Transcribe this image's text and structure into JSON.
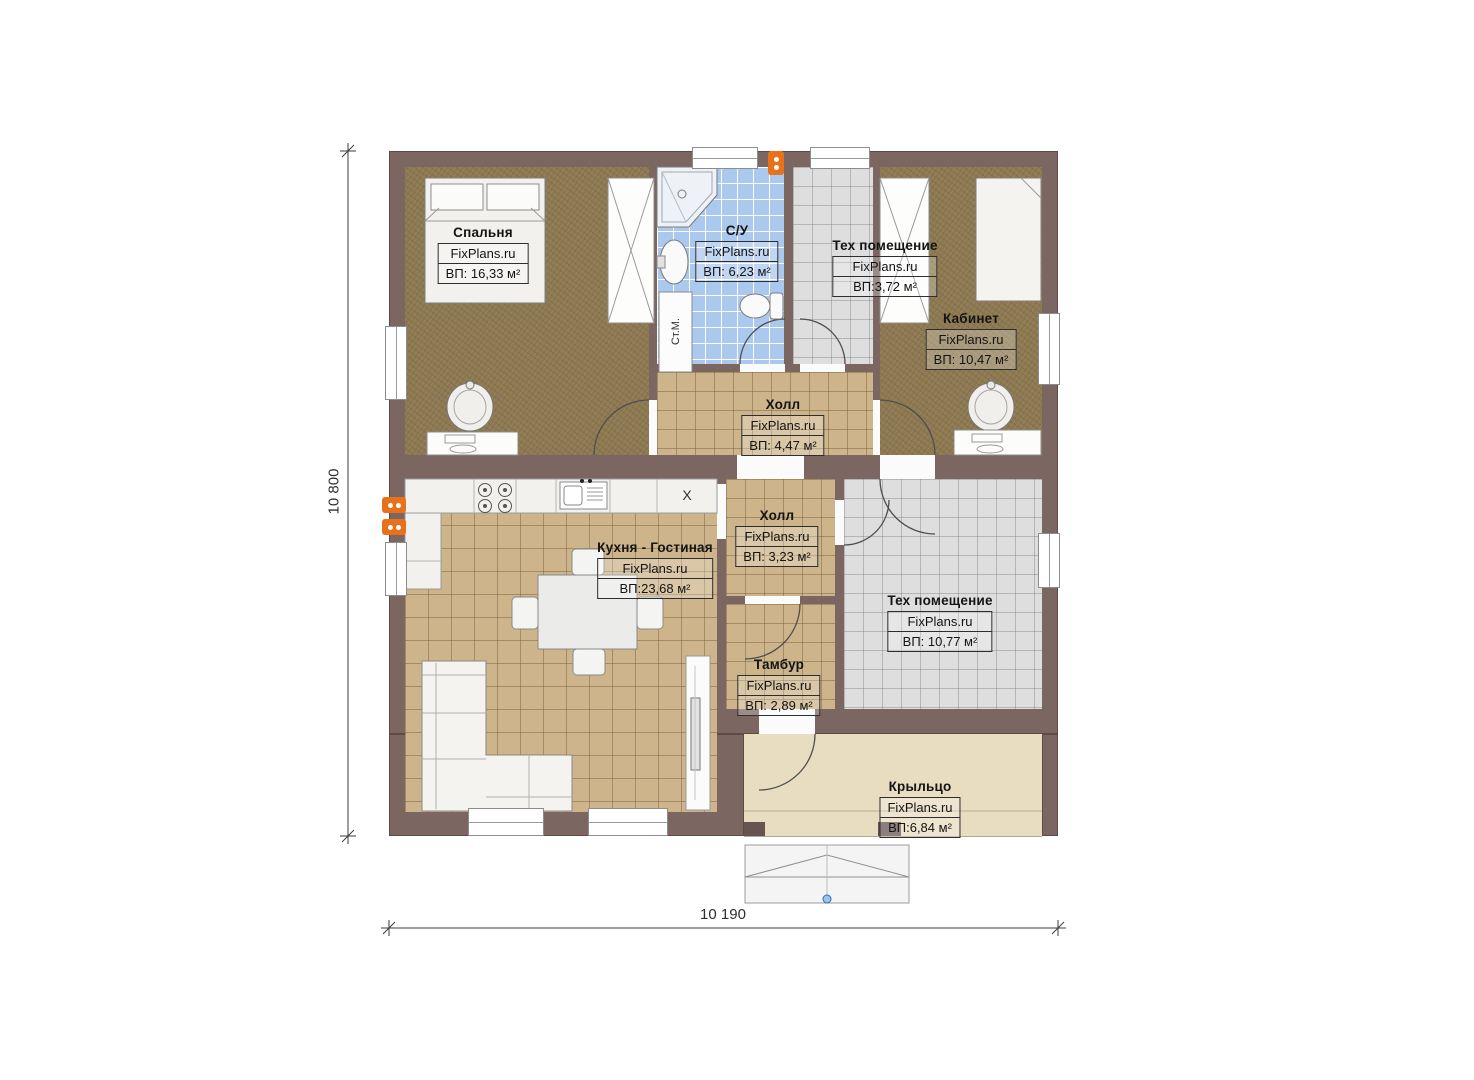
{
  "brand": "FixPlans.ru",
  "dimensions": {
    "height_label": "10 800",
    "width_label": "10 190"
  },
  "rooms": [
    {
      "id": "bedroom",
      "title": "Спальня",
      "brand": "FixPlans.ru",
      "area": "ВП: 16,33 м²"
    },
    {
      "id": "bathroom",
      "title": "С/У",
      "brand": "FixPlans.ru",
      "area": "ВП: 6,23 м²"
    },
    {
      "id": "tech-small",
      "title": "Тех помещение",
      "brand": "FixPlans.ru",
      "area": "ВП:3,72 м²"
    },
    {
      "id": "office",
      "title": "Кабинет",
      "brand": "FixPlans.ru",
      "area": "ВП: 10,47 м²"
    },
    {
      "id": "hall-upper",
      "title": "Холл",
      "brand": "FixPlans.ru",
      "area": "ВП: 4,47 м²"
    },
    {
      "id": "kitchen-living",
      "title": "Кухня - Гостиная",
      "brand": "FixPlans.ru",
      "area": "ВП:23,68 м²"
    },
    {
      "id": "hall-lower",
      "title": "Холл",
      "brand": "FixPlans.ru",
      "area": "ВП: 3,23 м²"
    },
    {
      "id": "tech-large",
      "title": "Тех помещение",
      "brand": "FixPlans.ru",
      "area": "ВП: 10,77 м²"
    },
    {
      "id": "tambour",
      "title": "Тамбур",
      "brand": "FixPlans.ru",
      "area": "ВП: 2,89 м²"
    },
    {
      "id": "porch",
      "title": "Крыльцо",
      "brand": "FixPlans.ru",
      "area": "ВП:6,84 м²"
    }
  ],
  "annotations": {
    "washing_machine": "Ст.М.",
    "fridge_mark": "X"
  },
  "colors": {
    "wall": "#7b6661",
    "wood_floor": "#8d7951",
    "tile_tan": "#cdb48a",
    "tile_blue": "#abc9ef",
    "tile_gray": "#dedede",
    "porch": "#e9ddc1",
    "accent_orange": "#e8721c"
  }
}
